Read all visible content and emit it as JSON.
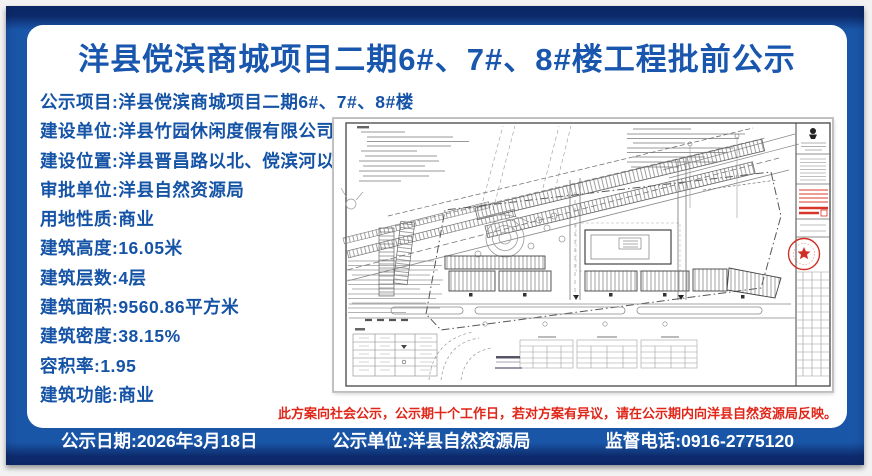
{
  "colors": {
    "poster_blue": "#1a56a8",
    "frame_navy": "#0c2a6b",
    "text_blue": "#1553a6",
    "alert_red": "#e02619",
    "seal_red": "#cf2f25",
    "paper_white": "#ffffff"
  },
  "header": {
    "title": "洋县傥滨商城项目二期6#、7#、8#楼工程批前公示"
  },
  "info": {
    "items": [
      "公示项目:洋县傥滨商城项目二期6#、7#、8#楼",
      "建设单位:洋县竹园休闲度假有限公司",
      "建设位置:洋县晋昌路以北、傥滨河以东",
      "审批单位:洋县自然资源局",
      "用地性质:商业",
      "建筑高度:16.05米",
      "建筑层数:4层",
      "建筑面积:9560.86平方米",
      "建筑密度:38.15%",
      "容积率:1.95",
      "建筑功能:商业"
    ]
  },
  "notice": "此方案向社会公示，公示期十个工作日，若对方案有异议，请在公示期内向洋县自然资源局反映。",
  "footer": {
    "date": "公示日期:2026年3月18日",
    "unit": "公示单位:洋县自然资源局",
    "phone": "监督电话:0916-2775120"
  }
}
